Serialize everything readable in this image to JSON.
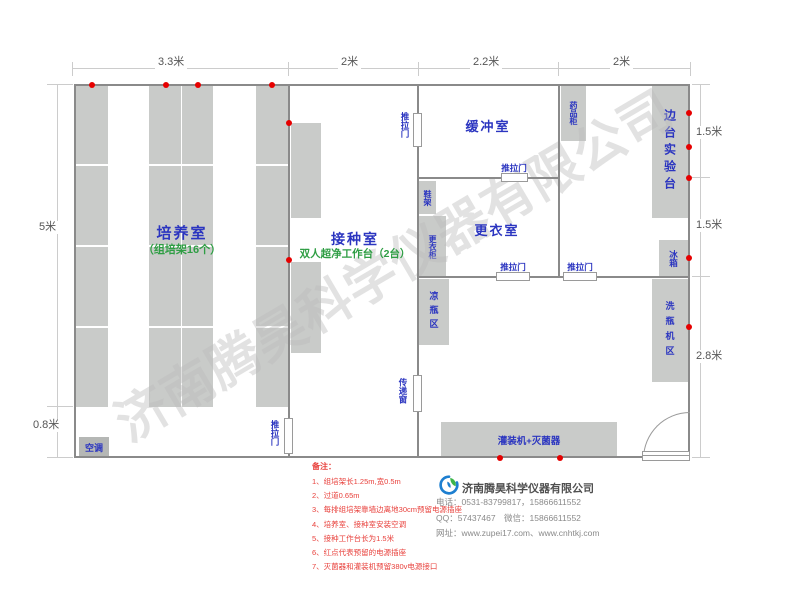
{
  "watermark": "济南腾昊科学仪器有限公司",
  "dims": {
    "top": [
      "3.3米",
      "2米",
      "2.2米",
      "2米"
    ],
    "left": [
      "5米",
      "0.8米"
    ],
    "right": [
      "1.5米",
      "1.5米",
      "2.8米"
    ]
  },
  "rooms": {
    "cultivation": {
      "name": "培养室",
      "sub": "（组培架16个）"
    },
    "inoculation": {
      "name": "接种室",
      "sub": "双人超净工作台（2台）"
    },
    "buffer": {
      "name": "缓冲室"
    },
    "changing": {
      "name": "更衣室"
    }
  },
  "labels": {
    "sliding_door": "推拉门",
    "transfer_window": "传递窗",
    "ac": "空调",
    "medicine_cabinet": "药品柜",
    "side_bench": "边台实验台",
    "shoe_rack": "鞋架",
    "wardrobe": "更衣柜",
    "fridge": "冰箱",
    "cool_bottle_area": "凉瓶区",
    "bottle_washer_area": "洗瓶机区",
    "filling_sterilizer": "灌装机+灭菌器"
  },
  "notes": {
    "title": "备注：",
    "items": [
      "1、组培架长1.25m,宽0.5m",
      "2、过道0.65m",
      "3、每排组培架靠墙边离地30cm预留电源插座",
      "4、培养室、接种室安装空调",
      "5、接种工作台长为1.5米",
      "6、红点代表预留的电源插座",
      "7、灭菌器和灌装机预留380v电源接口"
    ]
  },
  "company": {
    "name": "济南腾昊科学仪器有限公司",
    "phone": "电话：0531-83799817，15866611552",
    "qq": "QQ：57437467　微信：15866611552",
    "website": "网址：www.zupei17.com、www.cnhtkj.com"
  },
  "colors": {
    "room_label_blue": "#2b35c0",
    "sub_label_green": "#2f9e44",
    "furniture_gray": "#c9cbc9",
    "wall_gray": "#8a8a8a",
    "outlet_red": "#e60000",
    "note_red": "#e8413c"
  }
}
